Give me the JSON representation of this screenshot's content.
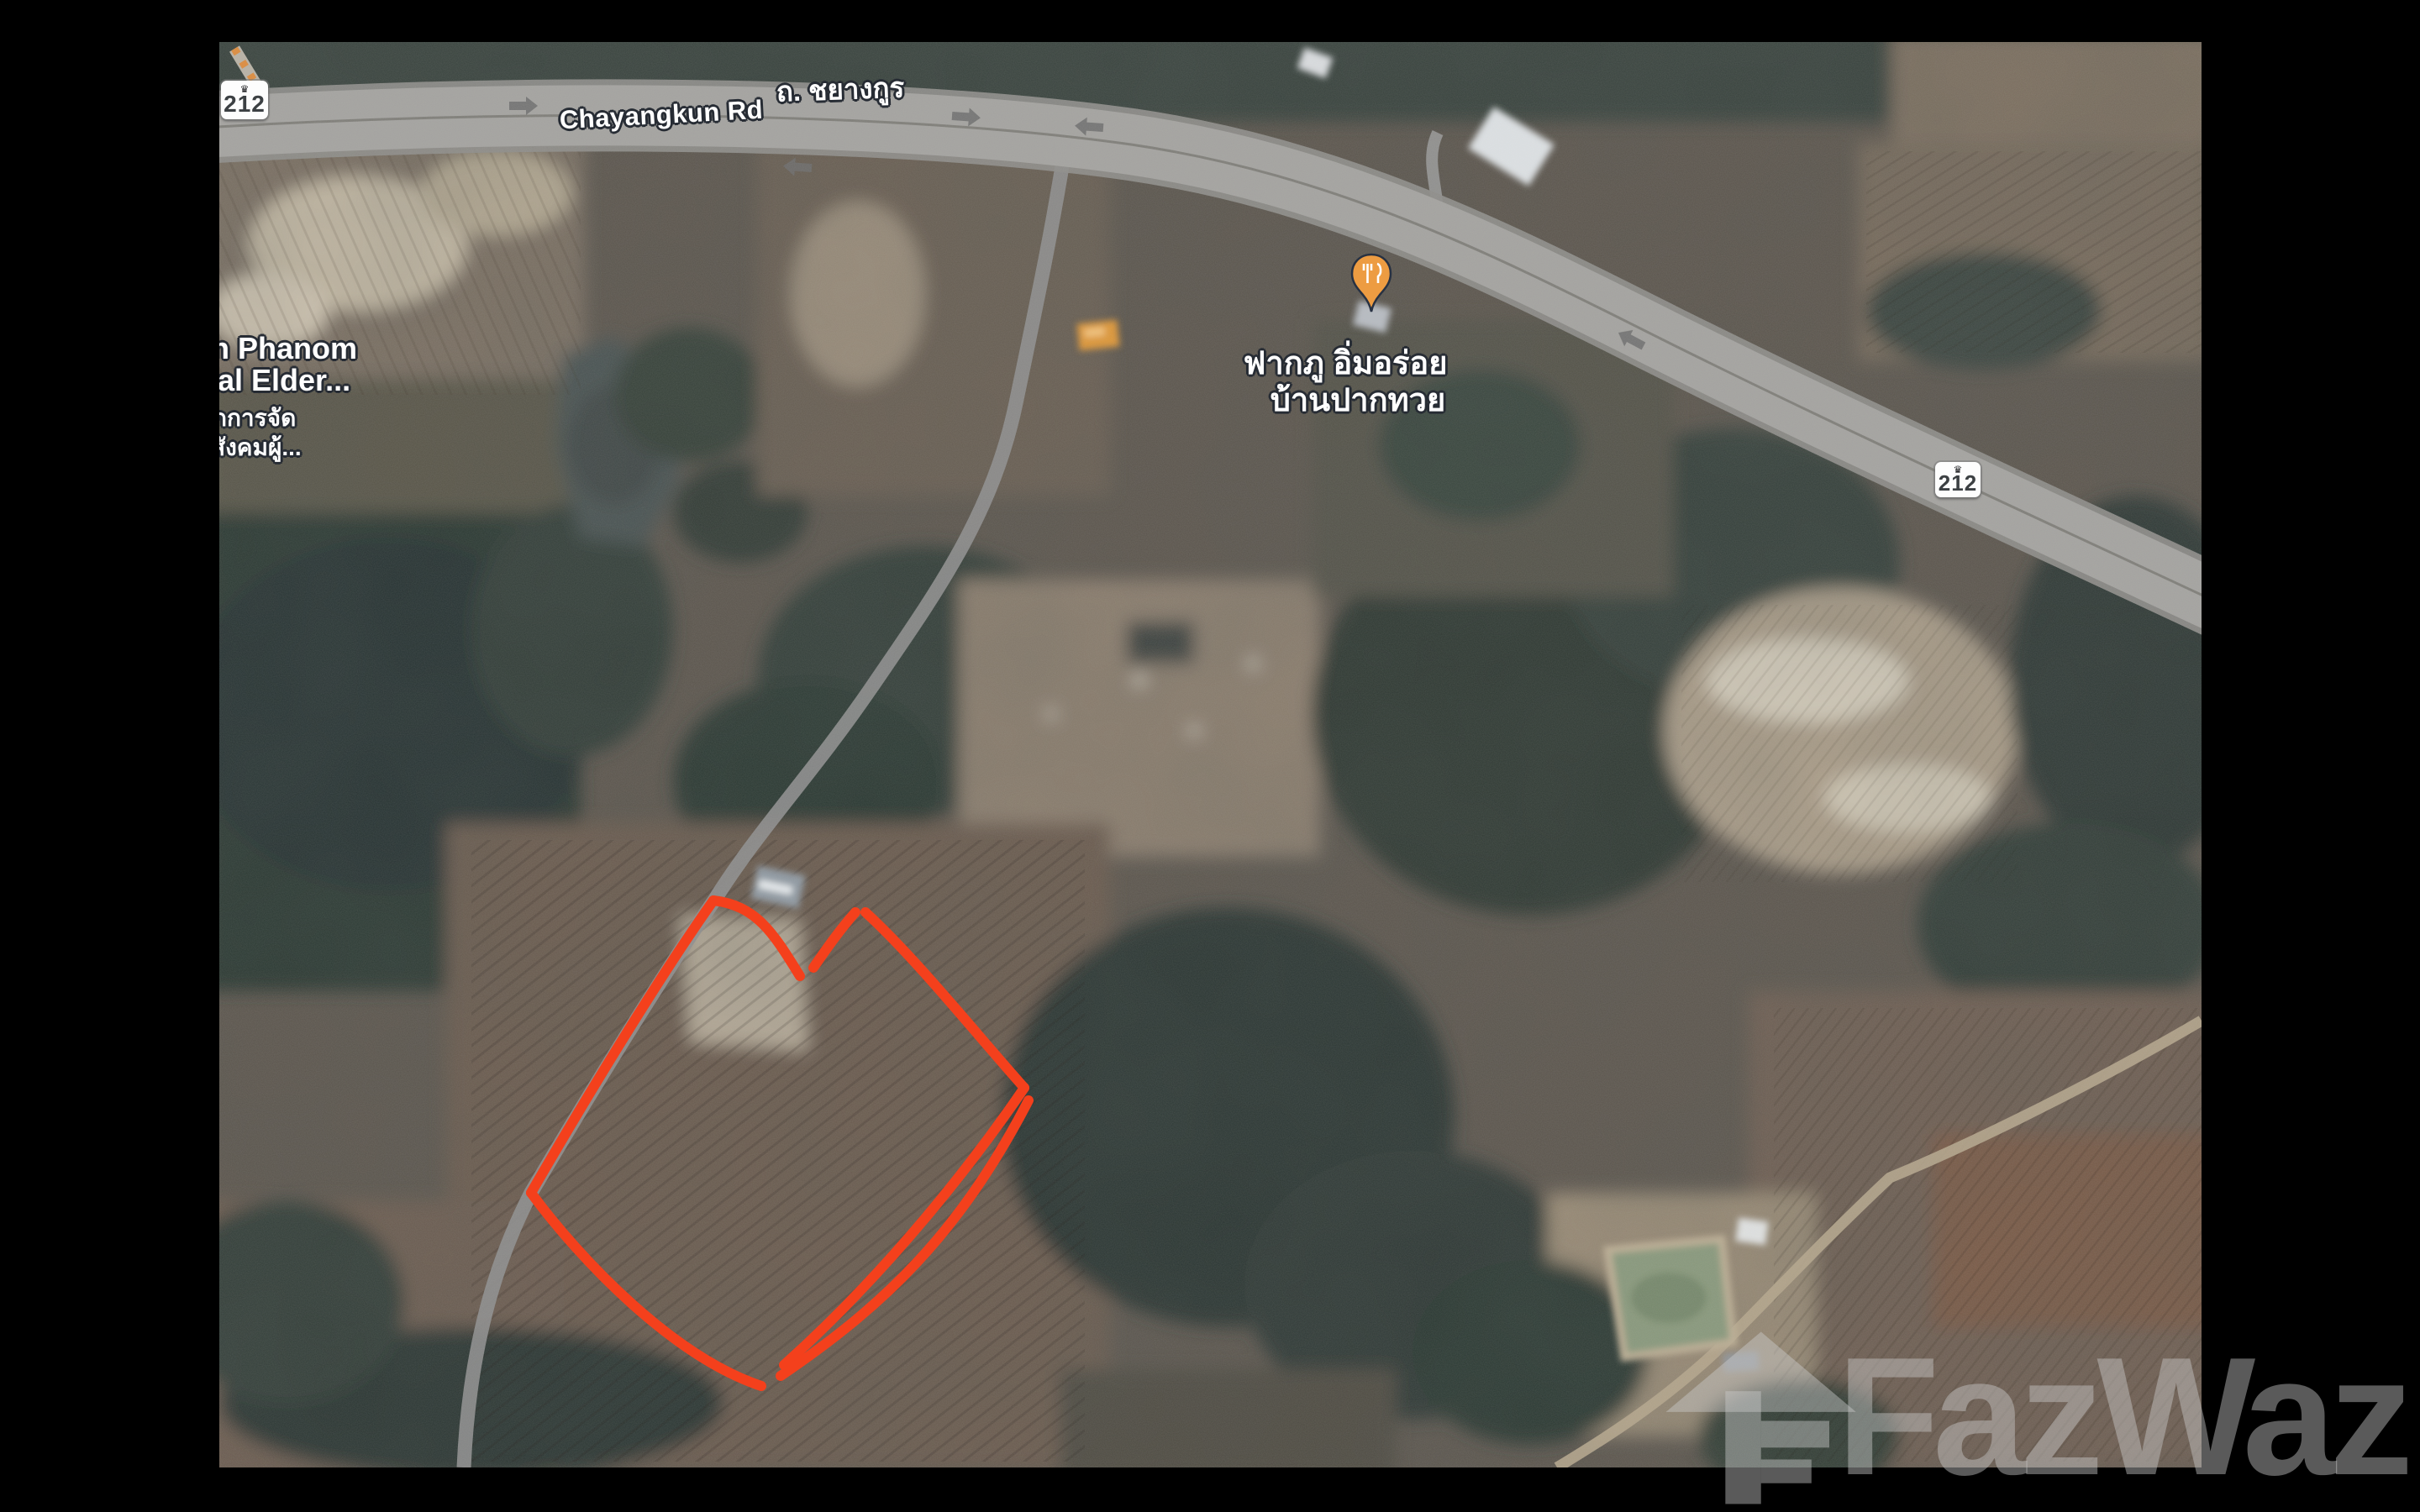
{
  "map": {
    "road_labels": {
      "thai": "ถ. ชยางกูร",
      "english": "Chayangkun Rd"
    },
    "route_shields": [
      {
        "number": "212",
        "crest_icon": "thai-highway-crest-icon"
      },
      {
        "number": "212",
        "crest_icon": "thai-highway-crest-icon"
      }
    ],
    "poi": {
      "icon": "restaurant-pin-icon",
      "name_line1": "ฟากภู อิ่มอร่อย",
      "name_line2": "บ้านปากทวย"
    },
    "clipped_place_label": {
      "line1": "n Phanom",
      "line2": "ial Elder...",
      "line3": "กการจัด",
      "line4": "สังคมผู้..."
    }
  },
  "watermark": {
    "brand": "FazWaz",
    "icon": "fazwaz-house-icon"
  },
  "colors": {
    "boundary": "#F4401C",
    "poi_pin": "#ED9C42",
    "road": "#A4A3A0",
    "watermark": "rgba(206,206,206,0.44)"
  }
}
